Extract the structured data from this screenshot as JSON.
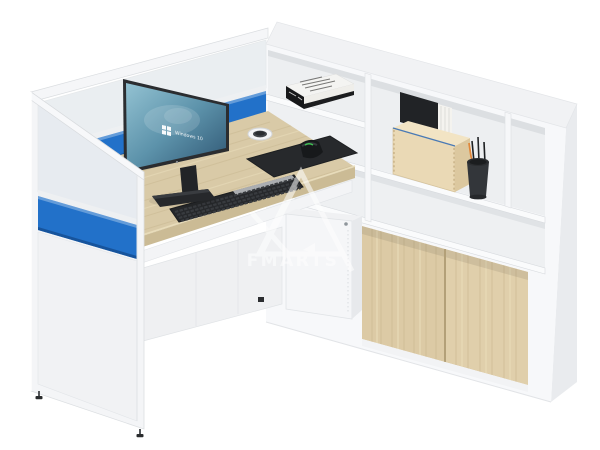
{
  "title": "Office workstation 3D product render",
  "watermark": {
    "brand": "FMARTS"
  },
  "monitor": {
    "os_label": "Windows 10"
  },
  "palette": {
    "accent_blue": "#2271c9",
    "desk_wood": "#d9caa7",
    "cabinet_door_wood": "#dccaa5",
    "panel_white": "#f4f5f7",
    "device_black": "#26282b",
    "screen_teal": "#6fa9bd",
    "pencil_orange": "#e0873a",
    "plywood_box": "#ead9b5"
  },
  "scene": {
    "objects": [
      "L-shaped workstation with white privacy partitions",
      "blue fabric screen bands with frosted glass toppers",
      "wood laminate desktop with cable grommet",
      "monitor on stand showing Windows 10 wallpaper",
      "black keyboard, mousepad and mouse",
      "white mug",
      "white open shelving unit with book on shelf",
      "plywood file box with black folder and papers",
      "black pen cup with pens and orange pencil",
      "lower cabinet with light-wood sliding doors",
      "small white under-desk cabinet"
    ]
  }
}
